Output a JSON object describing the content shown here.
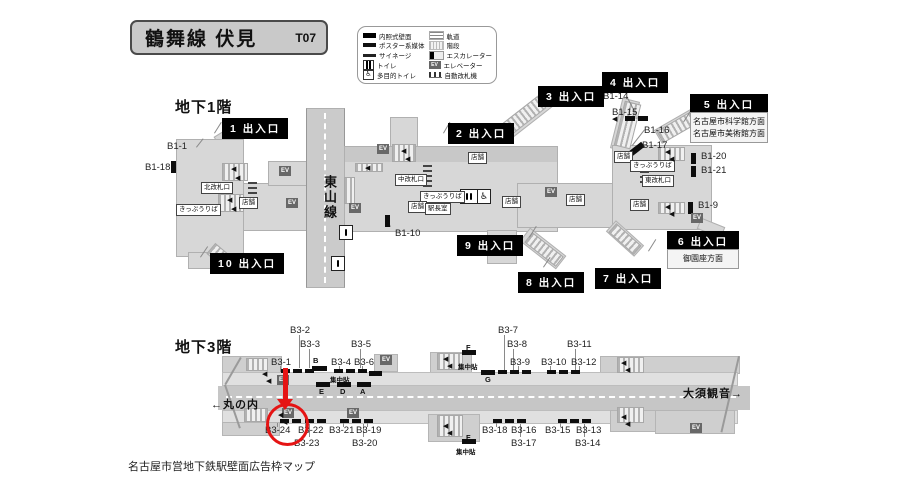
{
  "header": {
    "title": "鶴舞線  伏見",
    "station_code": "T07"
  },
  "caption": "名古屋市営地下鉄駅壁面広告枠マップ",
  "ev_label": "EV",
  "legend": {
    "left": [
      {
        "icon": "wall-sign",
        "label": "内照式壁面"
      },
      {
        "icon": "poster-media",
        "label": "ポスター系媒体"
      },
      {
        "icon": "signage",
        "label": "サイネージ"
      },
      {
        "icon": "toilet",
        "label": "トイレ"
      },
      {
        "icon": "multi-toilet",
        "label": "多目的トイレ"
      }
    ],
    "right": [
      {
        "icon": "track",
        "label": "軌道"
      },
      {
        "icon": "stairs",
        "label": "階段"
      },
      {
        "icon": "escalator",
        "label": "エスカレーター"
      },
      {
        "icon": "elevator",
        "label": "エレベーター"
      },
      {
        "icon": "ticket-gates",
        "label": "自動改札機"
      }
    ]
  },
  "annotation": {
    "circled_position": "B3-24",
    "color": "#e51414"
  },
  "floor1": {
    "heading": "地下1階",
    "line_label": "東山線",
    "exits": [
      {
        "label": "1 出入口",
        "x": 222,
        "y": 118
      },
      {
        "label": "2 出入口",
        "x": 448,
        "y": 123
      },
      {
        "label": "3 出入口",
        "x": 538,
        "y": 86
      },
      {
        "label": "4 出入口",
        "x": 602,
        "y": 72
      },
      {
        "label": "5 出入口",
        "x": 690,
        "y": 94,
        "w": 78,
        "info": [
          "名古屋市科学館方面",
          "名古屋市美術館方面"
        ]
      },
      {
        "label": "6 出入口",
        "x": 667,
        "y": 231,
        "w": 72,
        "info": [
          "御園座方面"
        ]
      },
      {
        "label": "7 出入口",
        "x": 595,
        "y": 268
      },
      {
        "label": "8 出入口",
        "x": 518,
        "y": 272
      },
      {
        "label": "9 出入口",
        "x": 457,
        "y": 235
      },
      {
        "label": "10 出入口",
        "x": 210,
        "y": 253
      }
    ],
    "ads": [
      {
        "t": "B1-1",
        "x": 167,
        "y": 141
      },
      {
        "t": "B1-18",
        "x": 145,
        "y": 162
      },
      {
        "t": "B1-10",
        "x": 395,
        "y": 228
      },
      {
        "t": "B1-14",
        "x": 603,
        "y": 91
      },
      {
        "t": "B1-15",
        "x": 612,
        "y": 107
      },
      {
        "t": "B1-16",
        "x": 644,
        "y": 125
      },
      {
        "t": "B1-17",
        "x": 642,
        "y": 140
      },
      {
        "t": "B1-20",
        "x": 701,
        "y": 151
      },
      {
        "t": "B1-21",
        "x": 701,
        "y": 165
      },
      {
        "t": "B1-9",
        "x": 698,
        "y": 200
      }
    ],
    "facilities": [
      {
        "t": "北改札口",
        "x": 201,
        "y": 182
      },
      {
        "t": "きっぷうりば",
        "x": 176,
        "y": 204
      },
      {
        "t": "店舗",
        "x": 239,
        "y": 197
      },
      {
        "t": "中改札口",
        "x": 395,
        "y": 174
      },
      {
        "t": "きっぷうりば",
        "x": 420,
        "y": 191
      },
      {
        "t": "店舗",
        "x": 408,
        "y": 201
      },
      {
        "t": "駅長室",
        "x": 425,
        "y": 203
      },
      {
        "t": "店舗",
        "x": 468,
        "y": 152
      },
      {
        "t": "店舗",
        "x": 502,
        "y": 196
      },
      {
        "t": "店舗",
        "x": 566,
        "y": 194
      },
      {
        "t": "店舗",
        "x": 614,
        "y": 151
      },
      {
        "t": "きっぷうりば",
        "x": 630,
        "y": 160
      },
      {
        "t": "東改札口",
        "x": 642,
        "y": 175
      },
      {
        "t": "店舗",
        "x": 630,
        "y": 199
      }
    ],
    "evs": [
      [
        279,
        166
      ],
      [
        286,
        198
      ],
      [
        349,
        203
      ],
      [
        377,
        144
      ],
      [
        545,
        187
      ],
      [
        691,
        213
      ]
    ],
    "bars": [
      [
        171,
        161,
        5,
        12
      ],
      [
        385,
        215,
        5,
        12
      ],
      [
        625,
        116,
        10,
        5
      ],
      [
        638,
        116,
        10,
        5
      ],
      [
        626,
        147,
        19,
        6,
        -38
      ],
      [
        691,
        153,
        5,
        11
      ],
      [
        691,
        166,
        5,
        11
      ],
      [
        688,
        202,
        5,
        12
      ]
    ],
    "stairs": [
      [
        222,
        163,
        26,
        18,
        0
      ],
      [
        218,
        194,
        26,
        18,
        0
      ],
      [
        355,
        163,
        28,
        9,
        0
      ],
      [
        392,
        144,
        24,
        18,
        0
      ],
      [
        344,
        177,
        11,
        27,
        0
      ],
      [
        497,
        110,
        50,
        15,
        -38
      ],
      [
        524,
        243,
        40,
        13,
        38
      ],
      [
        608,
        233,
        34,
        12,
        42
      ],
      [
        619,
        102,
        17,
        46,
        14
      ],
      [
        657,
        120,
        41,
        14,
        -30
      ],
      [
        658,
        147,
        27,
        14,
        0
      ],
      [
        658,
        202,
        27,
        12,
        0
      ],
      [
        208,
        249,
        24,
        14,
        40
      ]
    ],
    "leaders": [
      [
        196,
        147,
        11,
        -52
      ],
      [
        390,
        227,
        12,
        -115
      ],
      [
        627,
        96,
        19,
        62
      ],
      [
        636,
        111,
        8,
        85
      ],
      [
        645,
        130,
        20,
        128
      ],
      [
        643,
        145,
        17,
        142
      ],
      [
        214,
        133,
        13,
        -58
      ],
      [
        443,
        133,
        13,
        -60
      ],
      [
        588,
        103,
        15,
        -58
      ],
      [
        529,
        237,
        13,
        -58
      ],
      [
        543,
        267,
        12,
        -56
      ],
      [
        648,
        251,
        14,
        -58
      ],
      [
        683,
        122,
        13,
        -58
      ],
      [
        200,
        257,
        13,
        -56
      ]
    ],
    "arrows": [
      [
        231,
        166
      ],
      [
        235,
        175
      ],
      [
        227,
        197
      ],
      [
        231,
        206
      ],
      [
        365,
        165
      ],
      [
        401,
        148
      ],
      [
        405,
        156
      ],
      [
        665,
        149
      ],
      [
        669,
        156
      ],
      [
        665,
        204
      ],
      [
        669,
        211
      ],
      [
        612,
        116
      ]
    ],
    "toilets": [
      [
        460,
        189,
        "wc2"
      ],
      [
        477,
        189,
        "wh"
      ],
      [
        339,
        225,
        "wc1"
      ],
      [
        331,
        256,
        "wc1"
      ]
    ],
    "gates": [
      [
        248,
        180,
        14
      ],
      [
        423,
        163,
        24
      ],
      [
        640,
        169,
        14
      ]
    ]
  },
  "floor3": {
    "heading": "地下3階",
    "dirs": [
      {
        "t": "←丸の内",
        "x": 211,
        "y": 396
      },
      {
        "t": "大須観音→",
        "x": 683,
        "y": 385
      }
    ],
    "ads": [
      {
        "t": "B3-2",
        "x": 290,
        "y": 325
      },
      {
        "t": "B3-3",
        "x": 300,
        "y": 339
      },
      {
        "t": "B3-5",
        "x": 351,
        "y": 339
      },
      {
        "t": "B3-1",
        "x": 271,
        "y": 357
      },
      {
        "t": "B3-4",
        "x": 331,
        "y": 357
      },
      {
        "t": "B3-6",
        "x": 354,
        "y": 357
      },
      {
        "t": "B3-7",
        "x": 498,
        "y": 325
      },
      {
        "t": "B3-8",
        "x": 507,
        "y": 339
      },
      {
        "t": "B3-11",
        "x": 567,
        "y": 339
      },
      {
        "t": "B3-9",
        "x": 510,
        "y": 357
      },
      {
        "t": "B3-10",
        "x": 541,
        "y": 357
      },
      {
        "t": "B3-12",
        "x": 571,
        "y": 357
      },
      {
        "t": "B3-24",
        "x": 265,
        "y": 425
      },
      {
        "t": "B3-22",
        "x": 298,
        "y": 425
      },
      {
        "t": "B3-21",
        "x": 329,
        "y": 425
      },
      {
        "t": "B3-19",
        "x": 356,
        "y": 425
      },
      {
        "t": "B3-23",
        "x": 294,
        "y": 438
      },
      {
        "t": "B3-20",
        "x": 352,
        "y": 438
      },
      {
        "t": "B3-18",
        "x": 482,
        "y": 425
      },
      {
        "t": "B3-16",
        "x": 511,
        "y": 425
      },
      {
        "t": "B3-15",
        "x": 545,
        "y": 425
      },
      {
        "t": "B3-13",
        "x": 576,
        "y": 425
      },
      {
        "t": "B3-17",
        "x": 511,
        "y": 438
      },
      {
        "t": "B3-14",
        "x": 575,
        "y": 438
      }
    ],
    "letters": [
      {
        "t": "B",
        "x": 313,
        "y": 356
      },
      {
        "t": "C",
        "x": 374,
        "y": 369
      },
      {
        "t": "E",
        "x": 319,
        "y": 387
      },
      {
        "t": "D",
        "x": 340,
        "y": 387
      },
      {
        "t": "A",
        "x": 360,
        "y": 387
      },
      {
        "t": "F",
        "x": 466,
        "y": 343
      },
      {
        "t": "G",
        "x": 485,
        "y": 375
      },
      {
        "t": "F",
        "x": 466,
        "y": 433
      }
    ],
    "clusters": [
      {
        "t": "集中貼",
        "x": 330,
        "y": 374
      },
      {
        "t": "集中貼",
        "x": 458,
        "y": 361
      },
      {
        "t": "集中貼",
        "x": 456,
        "y": 446
      }
    ],
    "evs": [
      [
        277,
        375
      ],
      [
        282,
        408
      ],
      [
        347,
        408
      ],
      [
        380,
        355
      ],
      [
        690,
        423
      ]
    ],
    "bars": [
      [
        281,
        369,
        9,
        4
      ],
      [
        293,
        369,
        9,
        4
      ],
      [
        305,
        369,
        9,
        4
      ],
      [
        312,
        366,
        15,
        5
      ],
      [
        334,
        369,
        9,
        4
      ],
      [
        346,
        369,
        9,
        4
      ],
      [
        358,
        369,
        9,
        4
      ],
      [
        369,
        371,
        13,
        5
      ],
      [
        316,
        382,
        14,
        5
      ],
      [
        337,
        382,
        14,
        5
      ],
      [
        357,
        382,
        14,
        5
      ],
      [
        462,
        350,
        14,
        5
      ],
      [
        481,
        370,
        14,
        5
      ],
      [
        498,
        370,
        9,
        4
      ],
      [
        510,
        370,
        9,
        4
      ],
      [
        522,
        370,
        9,
        4
      ],
      [
        547,
        370,
        9,
        4
      ],
      [
        559,
        370,
        9,
        4
      ],
      [
        571,
        370,
        9,
        4
      ],
      [
        280,
        419,
        9,
        4
      ],
      [
        292,
        419,
        9,
        4
      ],
      [
        305,
        419,
        9,
        4
      ],
      [
        317,
        419,
        9,
        4
      ],
      [
        340,
        419,
        9,
        4
      ],
      [
        352,
        419,
        9,
        4
      ],
      [
        364,
        419,
        9,
        4
      ],
      [
        493,
        419,
        9,
        4
      ],
      [
        505,
        419,
        9,
        4
      ],
      [
        517,
        419,
        9,
        4
      ],
      [
        558,
        419,
        9,
        4
      ],
      [
        570,
        419,
        9,
        4
      ],
      [
        582,
        419,
        9,
        4
      ],
      [
        462,
        439,
        14,
        5
      ]
    ],
    "stairs": [
      [
        246,
        358,
        22,
        13,
        0
      ],
      [
        244,
        408,
        24,
        14,
        0
      ],
      [
        437,
        353,
        26,
        17,
        0
      ],
      [
        437,
        415,
        26,
        22,
        0
      ],
      [
        617,
        357,
        27,
        16,
        0
      ],
      [
        617,
        407,
        27,
        16,
        0
      ]
    ],
    "leaders": [
      [
        300,
        335,
        33,
        90
      ],
      [
        310,
        349,
        19,
        90
      ],
      [
        361,
        349,
        19,
        90
      ],
      [
        505,
        335,
        35,
        90
      ],
      [
        514,
        349,
        21,
        90
      ],
      [
        576,
        349,
        21,
        90
      ],
      [
        281,
        366,
        6,
        90
      ],
      [
        340,
        366,
        6,
        90
      ],
      [
        363,
        366,
        6,
        90
      ],
      [
        519,
        366,
        6,
        90
      ],
      [
        551,
        366,
        6,
        90
      ],
      [
        580,
        366,
        6,
        90
      ],
      [
        310,
        424,
        13,
        90
      ],
      [
        364,
        424,
        13,
        90
      ],
      [
        521,
        424,
        13,
        90
      ],
      [
        585,
        424,
        13,
        90
      ],
      [
        278,
        423,
        4,
        90
      ],
      [
        306,
        423,
        4,
        90
      ],
      [
        344,
        423,
        4,
        90
      ],
      [
        368,
        423,
        4,
        90
      ],
      [
        497,
        423,
        4,
        90
      ],
      [
        561,
        423,
        4,
        90
      ]
    ],
    "arrows": [
      [
        262,
        371
      ],
      [
        266,
        378
      ],
      [
        443,
        356
      ],
      [
        447,
        363
      ],
      [
        621,
        360
      ],
      [
        625,
        367
      ],
      [
        443,
        423
      ],
      [
        447,
        430
      ],
      [
        621,
        414
      ],
      [
        625,
        421
      ],
      [
        278,
        412
      ],
      [
        282,
        419
      ]
    ]
  }
}
